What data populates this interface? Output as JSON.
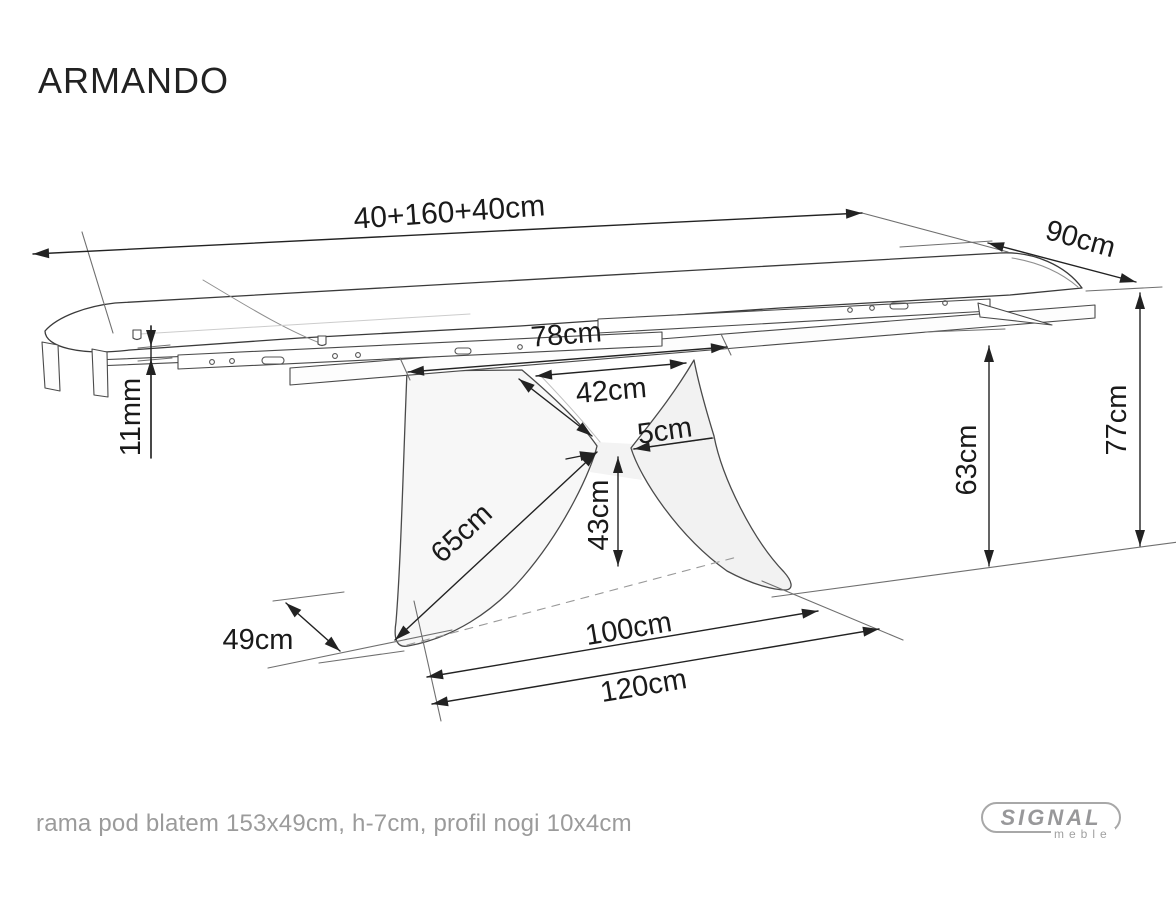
{
  "title": "ARMANDO",
  "footer": {
    "note": "rama pod blatem 153x49cm, h-7cm, profil nogi 10x4cm"
  },
  "logo": {
    "brand": "SIGNAL",
    "sub": "meble"
  },
  "diagram": {
    "subject": "extendable dining table technical drawing",
    "dims": {
      "total_length": "40+160+40cm",
      "depth": "90cm",
      "frame_span": "78cm",
      "leg_top_opening": "42cm",
      "waist_width": "5cm",
      "top_gap": "11mm",
      "clearance_height": "63cm",
      "table_height": "77cm",
      "leg_edge": "65cm",
      "waist_height": "43cm",
      "foot_depth": "49cm",
      "base_inner": "100cm",
      "base_outer": "120cm"
    },
    "colors": {
      "line": "#2f2f2f",
      "dimension": "#1a1a1a",
      "muted_line": "#8f8f8f",
      "leg_fill": "#f6f6f6",
      "text_muted": "#9b9b9b"
    }
  }
}
